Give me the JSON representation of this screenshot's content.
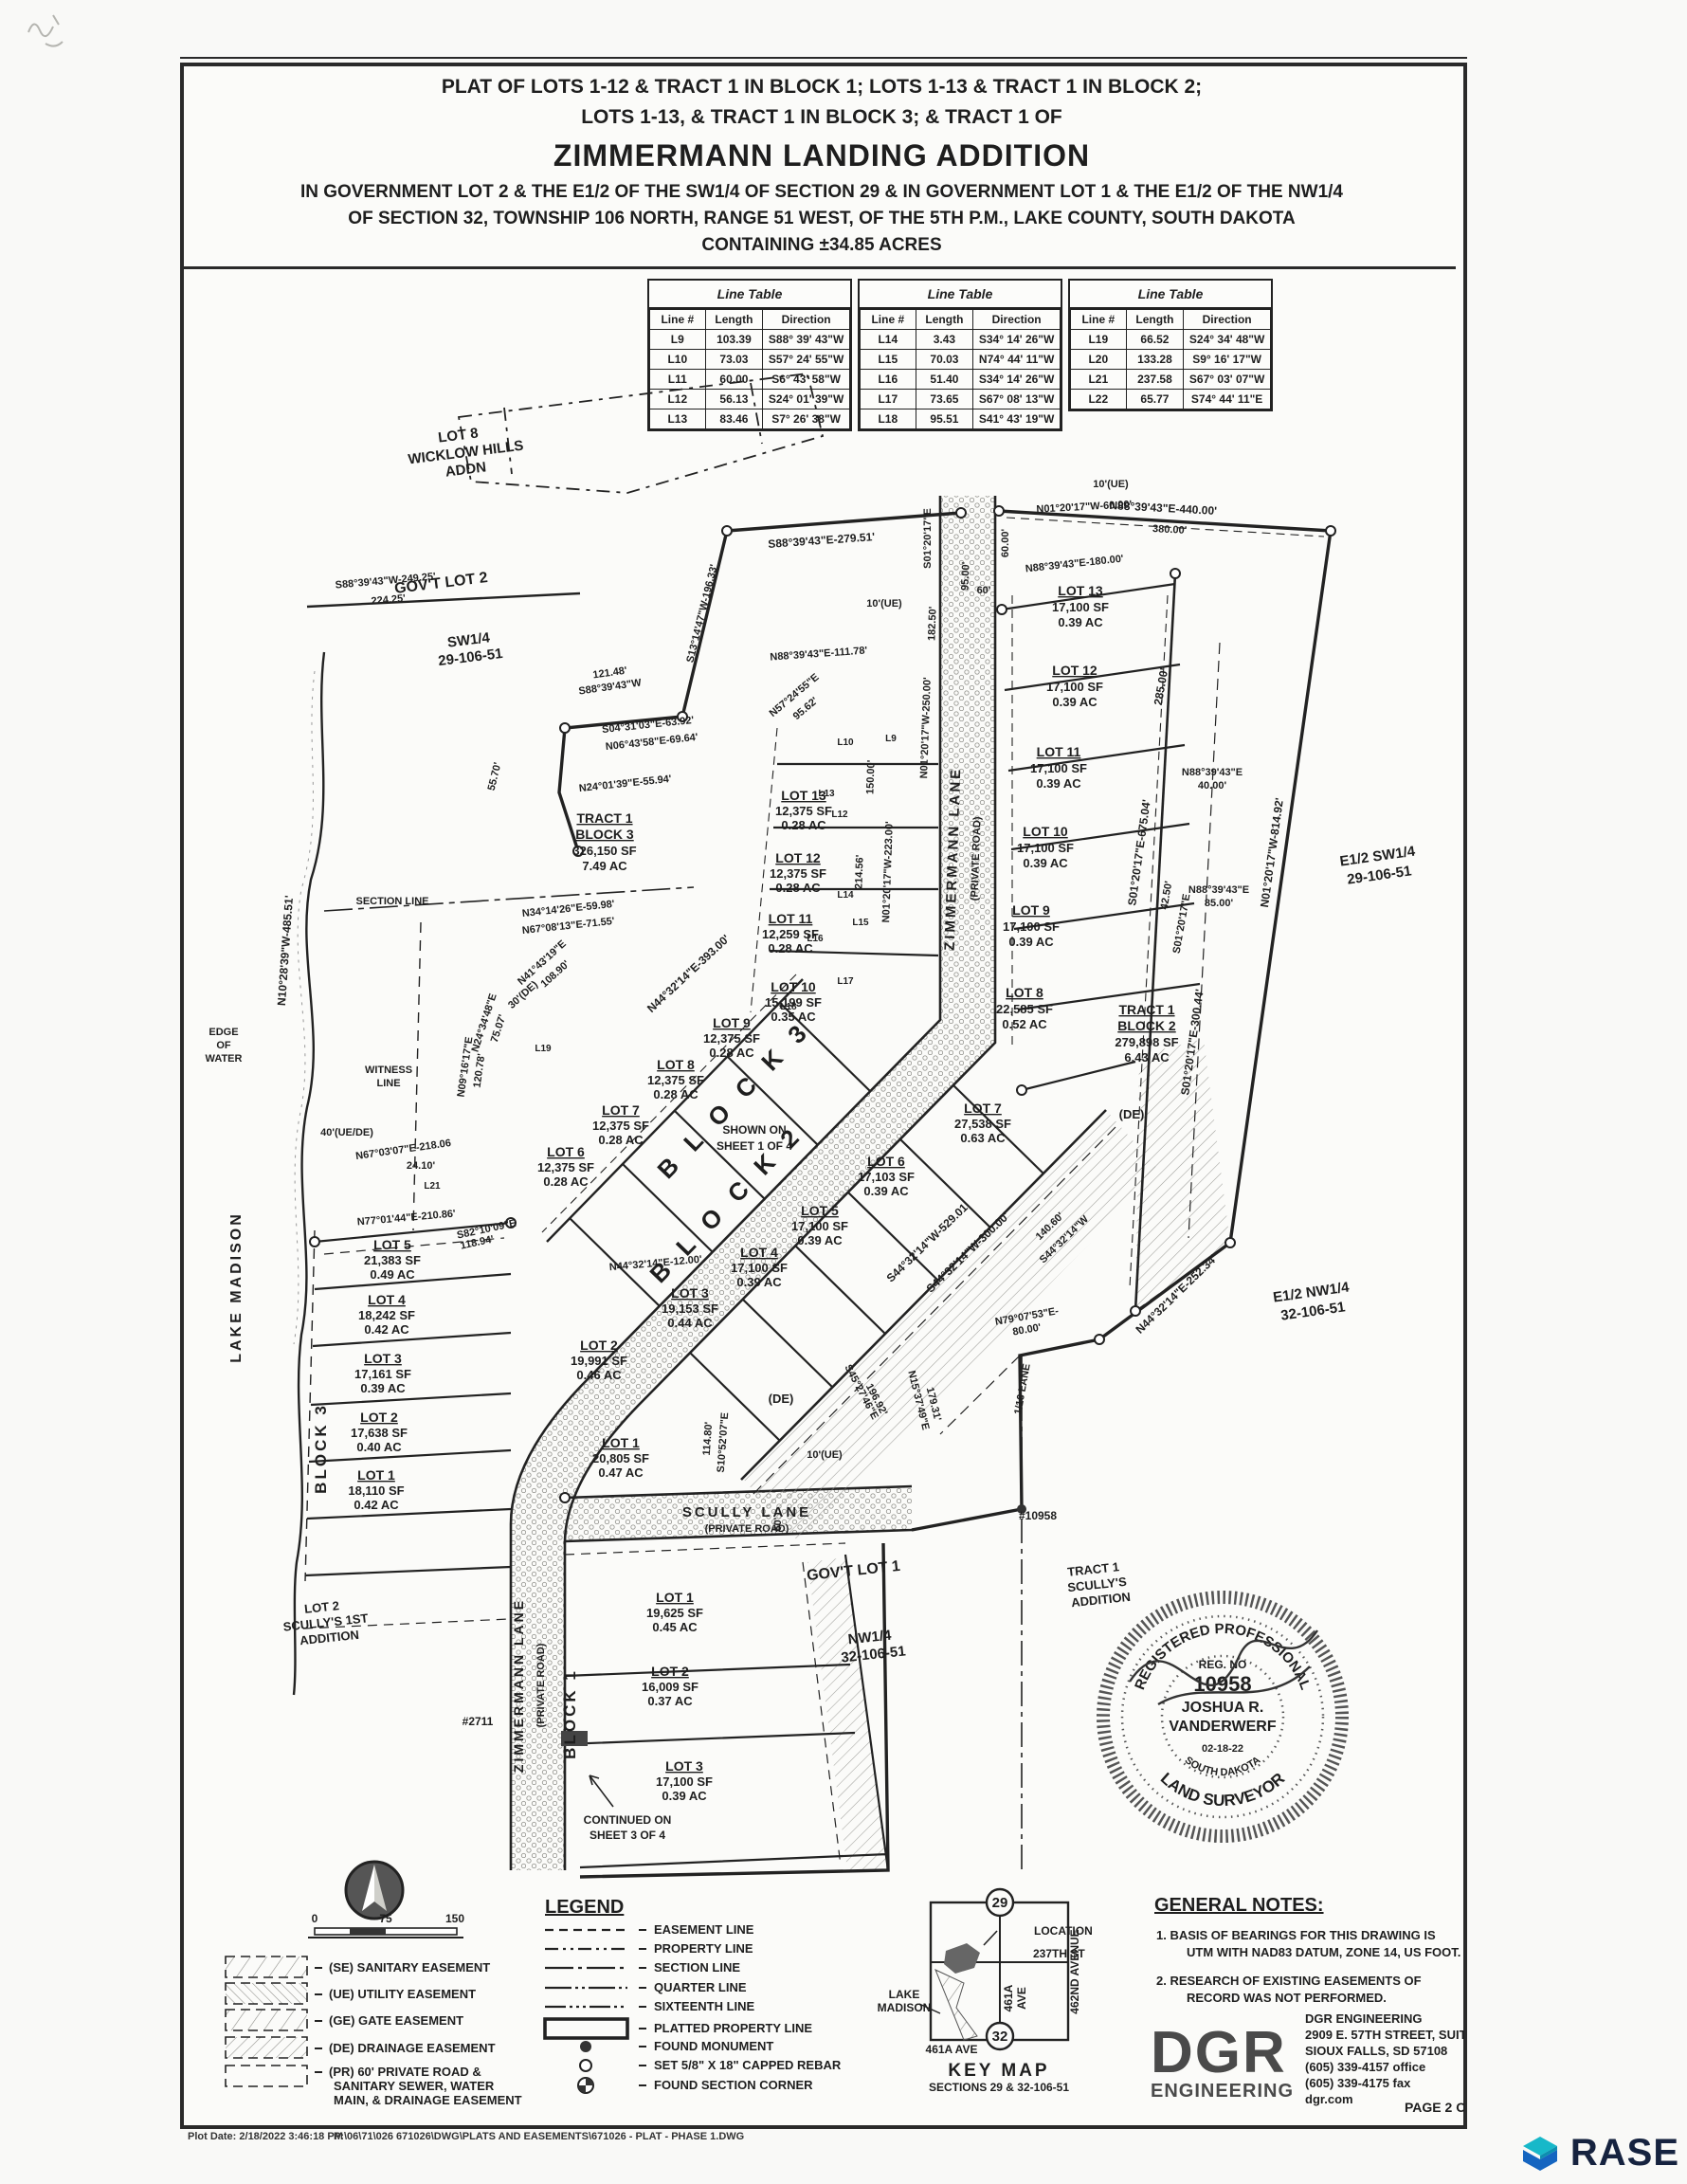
{
  "title_block": {
    "l1": "PLAT OF LOTS 1-12 & TRACT 1 IN BLOCK 1; LOTS 1-13 & TRACT 1 IN BLOCK 2;",
    "l2": "LOTS 1-13, & TRACT 1 IN BLOCK 3; & TRACT 1 OF",
    "l3": "ZIMMERMANN LANDING ADDITION",
    "l4": "IN GOVERNMENT LOT 2 & THE E1/2 OF THE SW1/4 OF SECTION 29 & IN GOVERNMENT LOT 1 & THE E1/2 OF THE NW1/4",
    "l5": "OF SECTION 32, TOWNSHIP 106 NORTH, RANGE 51 WEST, OF THE 5TH P.M., LAKE COUNTY, SOUTH DAKOTA",
    "l6": "CONTAINING ±34.85 ACRES"
  },
  "line_tables": {
    "title": "Line Table",
    "col_line": "Line #",
    "col_length": "Length",
    "col_dir": "Direction",
    "t1": [
      {
        "id": "L9",
        "len": "103.39",
        "dir": "S88° 39' 43\"W"
      },
      {
        "id": "L10",
        "len": "73.03",
        "dir": "S57° 24' 55\"W"
      },
      {
        "id": "L11",
        "len": "60.00",
        "dir": "S6° 43' 58\"W"
      },
      {
        "id": "L12",
        "len": "56.13",
        "dir": "S24° 01' 39\"W"
      },
      {
        "id": "L13",
        "len": "83.46",
        "dir": "S7° 26' 38\"W"
      }
    ],
    "t2": [
      {
        "id": "L14",
        "len": "3.43",
        "dir": "S34° 14' 26\"W"
      },
      {
        "id": "L15",
        "len": "70.03",
        "dir": "N74° 44' 11\"W"
      },
      {
        "id": "L16",
        "len": "51.40",
        "dir": "S34° 14' 26\"W"
      },
      {
        "id": "L17",
        "len": "73.65",
        "dir": "S67° 08' 13\"W"
      },
      {
        "id": "L18",
        "len": "95.51",
        "dir": "S41° 43' 19\"W"
      }
    ],
    "t3": [
      {
        "id": "L19",
        "len": "66.52",
        "dir": "S24° 34' 48\"W"
      },
      {
        "id": "L20",
        "len": "133.28",
        "dir": "S9° 16' 17\"W"
      },
      {
        "id": "L21",
        "len": "237.58",
        "dir": "S67° 03' 07\"W"
      },
      {
        "id": "L22",
        "len": "65.77",
        "dir": "S74° 44' 11\"E"
      }
    ]
  },
  "map": {
    "areas": {
      "wicklow1": "LOT 8",
      "wicklow2": "WICKLOW HILLS",
      "wicklow3": "ADDN",
      "govlot2": "GOV'T LOT 2",
      "sw14a": "SW1/4",
      "sw14b": "29-106-51",
      "e12sw14a": "E1/2 SW1/4",
      "e12sw14b": "29-106-51",
      "e12nw14a": "E1/2 NW1/4",
      "e12nw14b": "32-106-51",
      "govlot1": "GOV'T LOT 1",
      "nw14a": "NW1/4",
      "nw14b": "32-106-51",
      "tsc1": "TRACT 1",
      "tsc2": "SCULLY'S",
      "tsc3": "ADDITION",
      "sc1a": "LOT 2",
      "sc1b": "SCULLY'S 1ST",
      "sc1c": "ADDITION",
      "lakemadison": "LAKE MADISON",
      "edge1": "EDGE",
      "edge2": "OF",
      "edge3": "WATER",
      "wit1": "WITNESS",
      "wit2": "LINE",
      "sectionline": "SECTION LINE"
    },
    "roads": {
      "zim": "ZIMMERMANN LANE",
      "scully": "SCULLY LANE",
      "private": "(PRIVATE ROAD)"
    },
    "blocks": {
      "b3big": "B L O C K  3",
      "b2big": "B L O C K  2",
      "b3left": "BLOCK 3",
      "b1v": "BLOCK 1"
    },
    "notes_on_map": {
      "shown1": "SHOWN ON",
      "shown2": "SHEET 1 OF 4",
      "cont1": "CONTINUED ON",
      "cont2": "SHEET 3 OF 4",
      "mon1": "#10958",
      "mon2": "#2711",
      "sixteenth": "1/16 LANE"
    },
    "tracts": {
      "t1b3": {
        "n1": "TRACT 1",
        "n2": "BLOCK 3",
        "sf": "326,150 SF",
        "ac": "7.49 AC"
      },
      "t1b2": {
        "n1": "TRACT 1",
        "n2": "BLOCK 2",
        "sf": "279,898 SF",
        "ac": "6.43 AC"
      }
    },
    "lots": {
      "b2u": [
        {
          "name": "LOT 13",
          "sf": "17,100 SF",
          "ac": "0.39 AC"
        },
        {
          "name": "LOT 12",
          "sf": "17,100 SF",
          "ac": "0.39 AC"
        },
        {
          "name": "LOT 11",
          "sf": "17,100 SF",
          "ac": "0.39 AC"
        },
        {
          "name": "LOT 10",
          "sf": "17,100 SF",
          "ac": "0.39 AC"
        },
        {
          "name": "LOT 9",
          "sf": "17,100 SF",
          "ac": "0.39 AC"
        },
        {
          "name": "LOT 8",
          "sf": "22,585 SF",
          "ac": "0.52 AC"
        }
      ],
      "b2l": [
        {
          "name": "LOT 7",
          "sf": "27,538 SF",
          "ac": "0.63 AC"
        },
        {
          "name": "LOT 6",
          "sf": "17,103 SF",
          "ac": "0.39 AC"
        },
        {
          "name": "LOT 5",
          "sf": "17,100 SF",
          "ac": "0.39 AC"
        },
        {
          "name": "LOT 4",
          "sf": "17,100 SF",
          "ac": "0.39 AC"
        },
        {
          "name": "LOT 3",
          "sf": "19,153 SF",
          "ac": "0.44 AC"
        },
        {
          "name": "LOT 2",
          "sf": "19,991 SF",
          "ac": "0.46 AC"
        },
        {
          "name": "LOT 1",
          "sf": "20,805 SF",
          "ac": "0.47 AC"
        }
      ],
      "b3m": [
        {
          "name": "LOT 13",
          "sf": "12,375 SF",
          "ac": "0.28 AC"
        },
        {
          "name": "LOT 12",
          "sf": "12,375 SF",
          "ac": "0.28 AC"
        },
        {
          "name": "LOT 11",
          "sf": "12,259 SF",
          "ac": "0.28 AC"
        },
        {
          "name": "LOT 10",
          "sf": "15,199 SF",
          "ac": "0.35 AC"
        },
        {
          "name": "LOT 9",
          "sf": "12,375 SF",
          "ac": "0.28 AC"
        },
        {
          "name": "LOT 8",
          "sf": "12,375 SF",
          "ac": "0.28 AC"
        },
        {
          "name": "LOT 7",
          "sf": "12,375 SF",
          "ac": "0.28 AC"
        },
        {
          "name": "LOT 6",
          "sf": "12,375 SF",
          "ac": "0.28 AC"
        }
      ],
      "b3l": [
        {
          "name": "LOT 5",
          "sf": "21,383 SF",
          "ac": "0.49 AC"
        },
        {
          "name": "LOT 4",
          "sf": "18,242 SF",
          "ac": "0.42 AC"
        },
        {
          "name": "LOT 3",
          "sf": "17,161 SF",
          "ac": "0.39 AC"
        },
        {
          "name": "LOT 2",
          "sf": "17,638 SF",
          "ac": "0.40 AC"
        },
        {
          "name": "LOT 1",
          "sf": "18,110 SF",
          "ac": "0.42 AC"
        }
      ],
      "b1": [
        {
          "name": "LOT 1",
          "sf": "19,625 SF",
          "ac": "0.45 AC"
        },
        {
          "name": "LOT 2",
          "sf": "16,009 SF",
          "ac": "0.37 AC"
        },
        {
          "name": "LOT 3",
          "sf": "17,100 SF",
          "ac": "0.39 AC"
        }
      ]
    },
    "bearings": {
      "br01": "S88°39'43\"E-279.51'",
      "br02": "S01°20'17\"E",
      "br03": "60.00'",
      "br04": "10'(UE)",
      "br05": "N88°39'43\"E-440.00'",
      "br06": "380.00'",
      "br07": "N01°20'17\"W-60.00'",
      "br08": "N88°39'43\"E-180.00'",
      "br09": "285.00'",
      "br10": "S01°20'17\"E-675.04'",
      "br11a": "N88°39'43\"E",
      "br11b": "40.00'",
      "br12": "42.50'",
      "br13": "85.00'",
      "br14": "N01°20'17\"W-814.92'",
      "br15": "S01°20'17\"E-300.44'",
      "br16": "(DE)",
      "br17": "N01°20'17\"W-250.00'",
      "br18": "182.50'",
      "br19": "95.00'",
      "br20": "N01°20'17\"W-223.00'",
      "br21": "214.56'",
      "br22": "150.00'",
      "br23": "N44°32'14\"E-393.00'",
      "br24": "N44°32'14\"E-12.00'",
      "br25": "S44°32'14\"W-529.01'",
      "br26": "S44°32'14\"W-300.00'",
      "br27": "N44°32'14\"E-252.34'",
      "br28a": "140.60'",
      "br28b": "S44°32'14\"W",
      "br29a": "N79°07'53\"E-",
      "br29b": "80.00'",
      "br30a": "S45°27'46\"E",
      "br30b": "196.92'",
      "br31a": "N15°37'49\"E",
      "br31b": "179.31'",
      "br32a": "114.80'",
      "br32b": "S10°52'07\"E",
      "br33": "S88°39'43\"W-249.25'",
      "br34": "224.25'",
      "br35": "121.48'",
      "br36": "S88°39'43\"W",
      "br37": "S13°14'47\"W-196.33'",
      "br38": "N88°39'43\"E-111.78'",
      "br39a": "N57°24'55\"E",
      "br39b": "95.62'",
      "br40": "S04°31'03\"E-63.92'",
      "br41": "N06°43'58\"E-69.64'",
      "br42": "N24°01'39\"E-55.94'",
      "br43": "55.70'",
      "br44": "N34°14'26\"E-59.98'",
      "br45": "N67°08'13\"E-71.55'",
      "br46a": "N41°43'19\"E",
      "br46b": "108.90'",
      "br47": "30'(DE)",
      "br48a": "N24°34'48\"E",
      "br48b": "75.07'",
      "br49a": "N09°16'17\"E",
      "br49b": "120.78'",
      "br50": "N10°28'39\"W-485.51'",
      "br51": "40'(UE/DE)",
      "br52": "N67°03'07\"E-218.06",
      "br53": "24.10'",
      "br54": "N77°01'44\"E-210.86'",
      "br55a": "S82°10'09\"E",
      "br55b": "118.94'",
      "br56": "60'",
      "lr9": "L9",
      "lr10": "L10",
      "lr12": "L12",
      "lr13": "L13",
      "lr14": "L14",
      "lr15": "L15",
      "lr16": "L16",
      "lr17": "L17",
      "lr18": "L18",
      "lr19": "L19",
      "lr21": "L21"
    }
  },
  "seal": {
    "arc_top": "REGISTERED PROFESSIONAL",
    "arc_bottom": "LAND SURVEYOR",
    "reg": "REG. NO",
    "num": "10958",
    "name1": "JOSHUA R.",
    "name2": "VANDERWERF",
    "date": "02-18-22",
    "state": "SOUTH DAKOTA"
  },
  "scalebar": {
    "n0": "0",
    "n75": "75",
    "n150": "150"
  },
  "easements": {
    "se": "(SE) SANITARY EASEMENT",
    "ue": "(UE) UTILITY EASEMENT",
    "ge": "(GE) GATE EASEMENT",
    "de": "(DE) DRAINAGE EASEMENT",
    "pr1": "(PR) 60' PRIVATE ROAD &",
    "pr2": "SANITARY SEWER, WATER",
    "pr3": "MAIN, & DRAINAGE EASEMENT"
  },
  "legend": {
    "heading": "LEGEND",
    "easement": "EASEMENT LINE",
    "property": "PROPERTY LINE",
    "section": "SECTION LINE",
    "quarter": "QUARTER LINE",
    "sixteenth": "SIXTEENTH LINE",
    "platted": "PLATTED PROPERTY LINE",
    "monument": "FOUND MONUMENT",
    "rebar": "SET 5/8\" X 18\" CAPPED REBAR",
    "corner": "FOUND SECTION CORNER"
  },
  "key_map": {
    "s29": "29",
    "s32": "32",
    "location": "LOCATION",
    "st": "237TH ST",
    "ave461a": "461A",
    "ave461b": "AVE",
    "ave461bottom": "461A AVE",
    "ave462": "462ND AVENUE",
    "lake1": "LAKE",
    "lake2": "MADISON",
    "title": "KEY MAP",
    "subtitle": "SECTIONS 29 & 32-106-51"
  },
  "notes": {
    "heading": "GENERAL NOTES:",
    "n1a": "1.   BASIS OF BEARINGS FOR THIS DRAWING IS",
    "n1b": "UTM WITH NAD83 DATUM, ZONE 14, US FOOT.",
    "n2a": "2.   RESEARCH OF EXISTING EASEMENTS OF",
    "n2b": "RECORD WAS NOT PERFORMED."
  },
  "firm": {
    "logo1": "DGR",
    "logo2": "ENGINEERING",
    "l1": "DGR ENGINEERING",
    "l2": "2909 E. 57TH STREET, SUITE 101",
    "l3": "SIOUX FALLS, SD  57108",
    "l4": "(605) 339-4157 office",
    "l5": "(605) 339-4175 fax",
    "l6": "dgr.com",
    "page": "PAGE 2 OF 4"
  },
  "footer": {
    "plot": "Plot Date:   2/18/2022 3:46:18 PM",
    "path": "P:\\06\\71\\026 671026\\DWG\\PLATS AND EASEMENTS\\671026 - PLAT - PHASE 1.DWG"
  },
  "brand": {
    "name": "RASE"
  }
}
